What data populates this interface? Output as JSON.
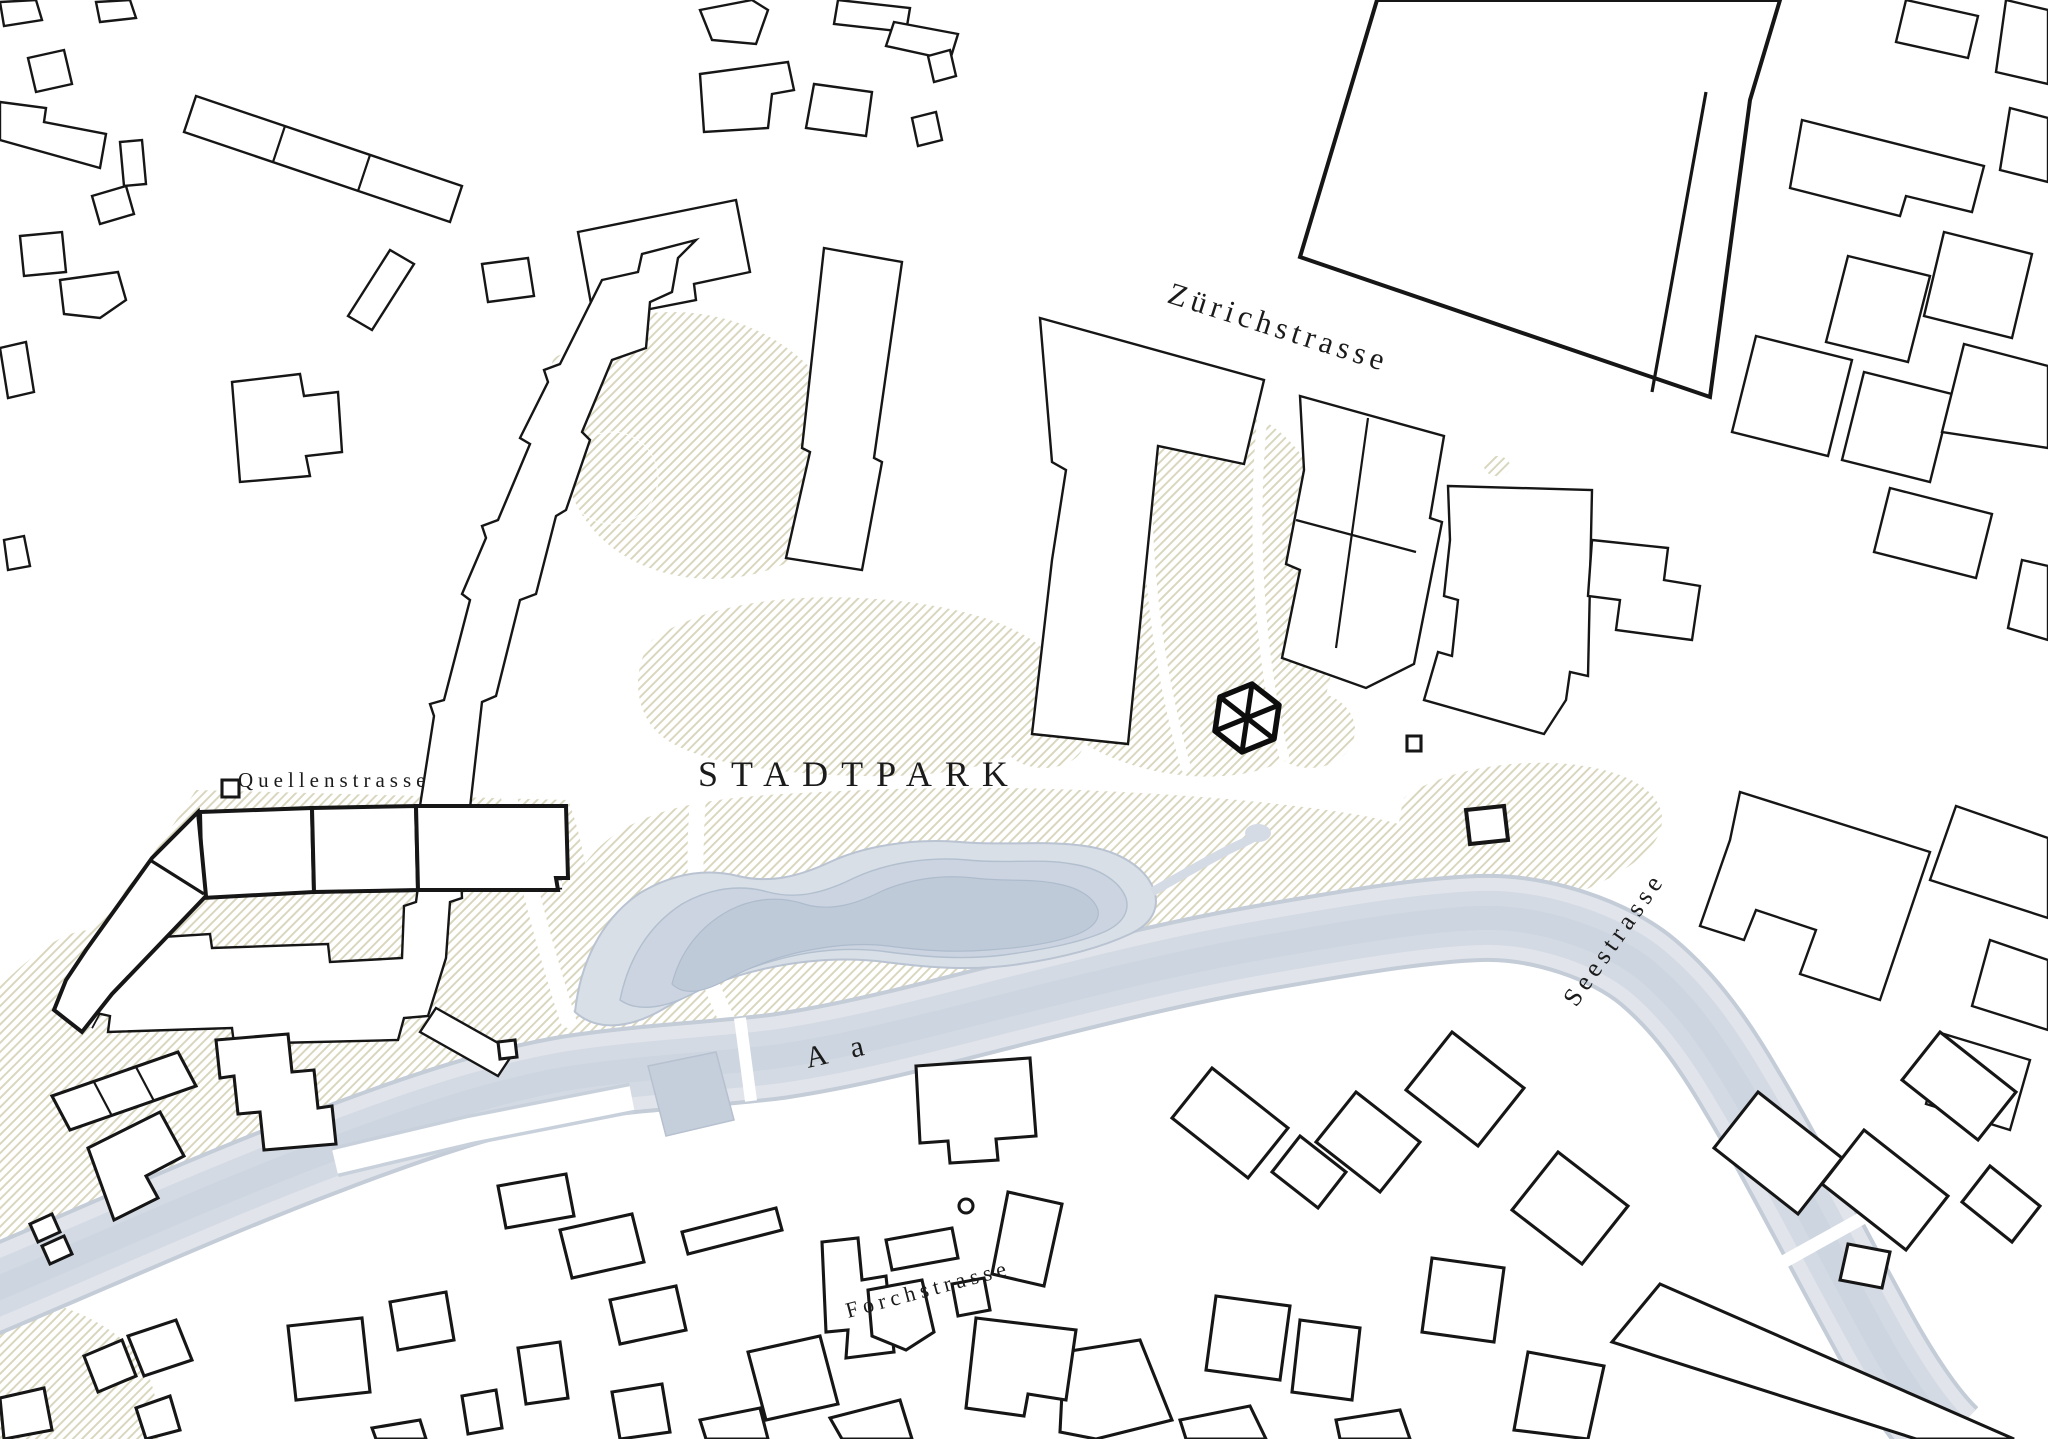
{
  "map": {
    "type": "architectural-site-plan",
    "labels": {
      "park": "STADTPARK",
      "street_north": "Zürichstrasse",
      "street_west": "Quellenstrasse",
      "street_east": "Seestrasse",
      "street_south": "Forchstrasse",
      "river": "A a"
    },
    "marker": {
      "shape": "hexagon-with-spokes",
      "meaning": "site-location-marker"
    },
    "colors": {
      "background": "#ffffff",
      "building_outline": "#161616",
      "park_hatch_line": "#d8d5bc",
      "water_light": "#e1e5eb",
      "water": "#d4dae3",
      "water_mid": "#cad3de",
      "water_deep": "#c0cbd8",
      "park_label": "#93a164",
      "river_label": "#8b9097",
      "street_label": "#1b1b1b"
    }
  }
}
